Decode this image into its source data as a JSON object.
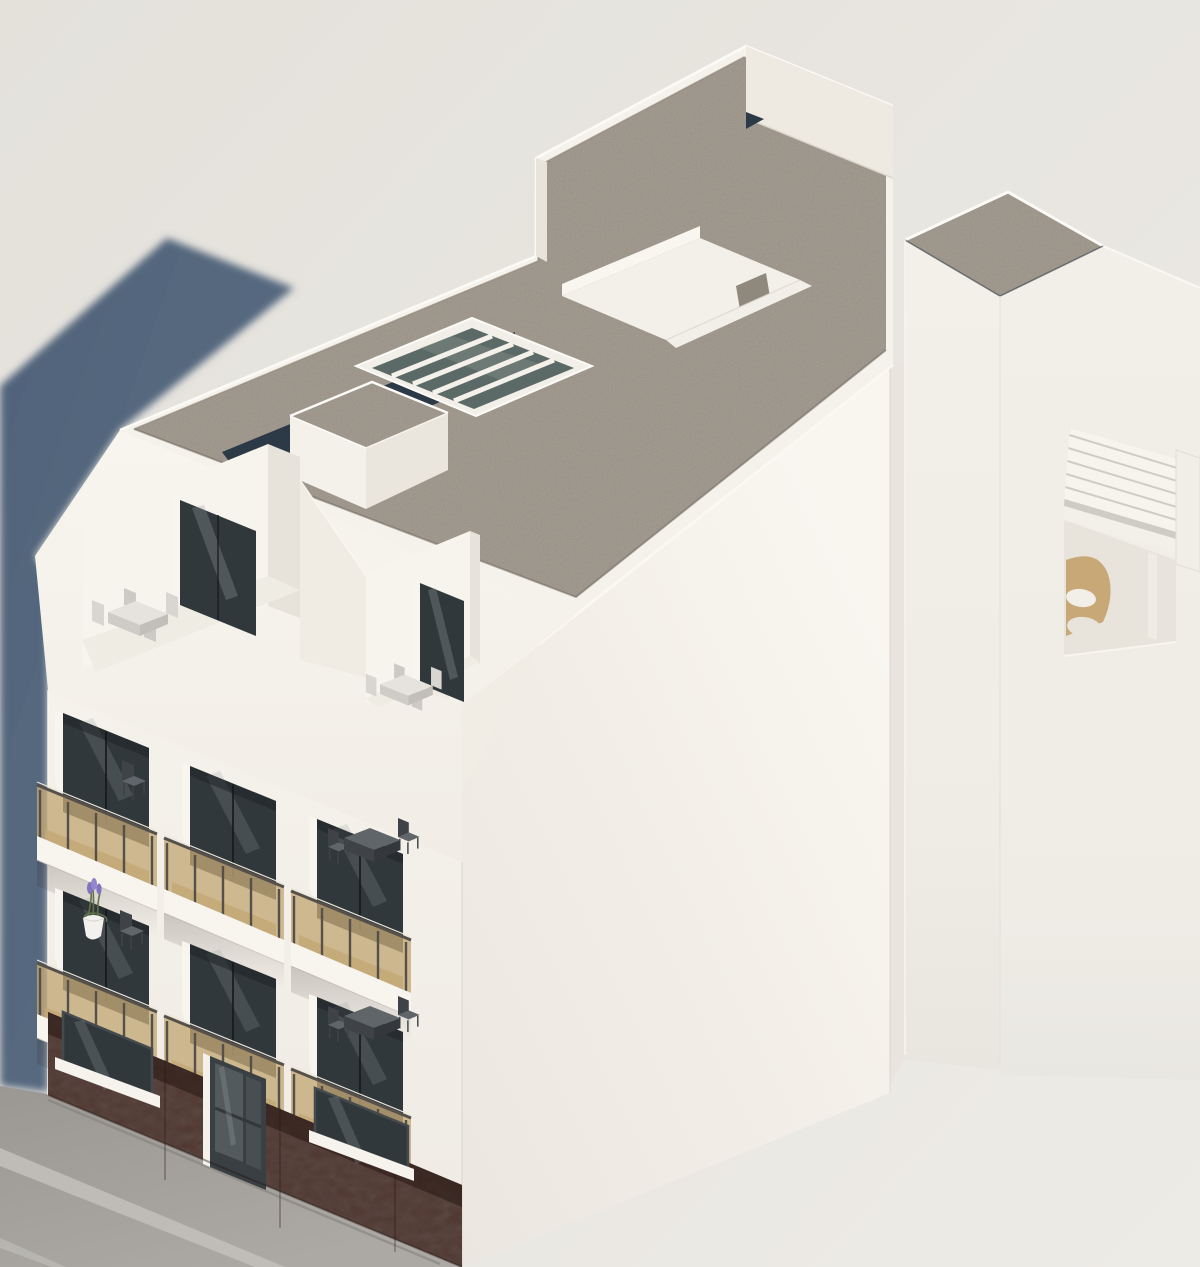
{
  "scene": {
    "type": "exterior architectural 3D rendering",
    "view": "aerial axonometric bird's-eye view of a corner apartment building in bright sunlight",
    "lighting": "sun from upper right; soft blue-grey shadow of the building cast on the left background",
    "building": {
      "style": "modern white rendered residential block",
      "roof": {
        "finish": "grey-tan gravel flat roof with white parapets",
        "features": [
          "glass skylight with four white ribs",
          "white rooftop access box with gravel top",
          "dark navy lower roof strip behind front parapet",
          "recessed white courtyard lightwell with small window",
          "stepped raised parapet wall at the rear",
          "taller white stair/elevator core volume with gravel roof"
        ]
      },
      "attic": {
        "terraces": 2,
        "terrace_description": "recessed roof terraces with sliding glass doors, white sloped mansard cheeks and light outdoor dining sets",
        "dining_set_left_chairs": 4,
        "dining_set_right_chairs": 2
      },
      "facade": {
        "balcony_rows": 2,
        "balconies_per_row": 3,
        "balcony_count": 6,
        "balustrade": "bronze tinted glass panels with dark metal posts and handrail",
        "balcony_floor": "warm tan wood-look decking",
        "windows": "full-height recessed sliding glass doors with dark frames and white reveals",
        "decor": "lavender plant in a white pot on the lower-left balcony ledge",
        "furniture": "small dark bistro table and chairs on the right balconies"
      },
      "ground_floor": {
        "cladding": "dark red-brown panels",
        "openings": [
          "display window",
          "glass entrance door",
          "display window"
        ],
        "sills": "white projecting sills"
      },
      "side_wall": "large blank white gable wall with soft diagonal light gradient"
    },
    "neighbor": {
      "pergola_terrace": "white slatted pergola roof terrace with a tan rounded lounge chair and white cushions"
    },
    "street": {
      "sidewalk": "grey concrete sidewalk with two lighter curb joint lines, bottom-left corner"
    }
  },
  "colors": {
    "background_top": "#e4e1db",
    "background_bottom": "#edebe6",
    "shadow_blue": "#5b6e84",
    "shadow_blue_deep": "#50637a",
    "wall_white": "#f5f2ec",
    "wall_bright": "#faf7f1",
    "wall_shaded": "#e9e5de",
    "wall_warm": "#efebe3",
    "roof_gravel": "#b4a99b",
    "roof_navy": "#2c3947",
    "skylight_glass": "#5c6a67",
    "window_glass": "#31383c",
    "window_frame": "#454a4e",
    "glass_reflection": "#97a0a3",
    "balcony_glass": "#c3a876",
    "balcony_floor": "#c9aa7c",
    "railing": "#55504a",
    "slab_white": "#f8f5ef",
    "brick": "#4c2f27",
    "brick_shadow": "#2e1d18",
    "sidewalk": "#a5a29e",
    "sidewalk_curb": "#c2bfba",
    "door_glass": "#525a5e",
    "furniture_dark": "#3f4347",
    "furniture_mid": "#60656a",
    "furniture_light": "#d9d6d1",
    "plant_green": "#5f7247",
    "plant_purple": "#8073c0",
    "plant_pot": "#f3f1ed",
    "pergola_chair": "#c9a877",
    "courtyard_window": "#8f897d"
  }
}
